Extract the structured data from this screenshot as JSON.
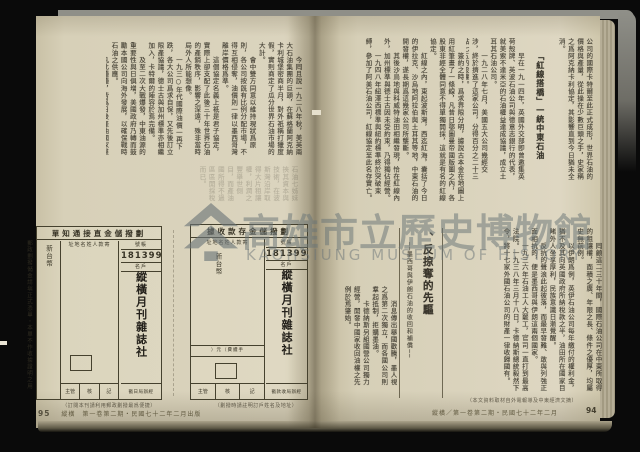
{
  "watermark": {
    "institution": "高雄市立歷史博物館",
    "institution_en": "KAOHSIUNG MUSEUM OF HISTORY"
  },
  "left_page": {
    "page_number": "95",
    "footer": "縱橫　第一卷第二期・民國七十二年二月出版",
    "body_paragraphs": [
      "　　今囘且說一九二八年秋，美英兩大石油集團的巨頭，在蘇格蘭阿克納卡利城堡密商半月，對外祇稱打獵度假，實則商定了瓜分世界石油市場的大計。",
      "　　會中雙方同意以維持現狀爲原則，各公司按旣有比例分配市場，不得互相侵奪，油價則一律以墨西哥灣離岸價格爲準。",
      "　　這個協定名義上祇是君子協定，實際上卻支配了此後三十年世界石油的產銷秩序，影響之深遠，殊非當時局外人所能想像。",
      "　　一九三○年代國際油價一再下跌，各大公司爲求自保，又先後訂立限產協議，德士古與加州標準亦相繼加入，卡特爾的陣容於焉完備。",
      "　　及至二次大戰爆發，中東油源的重要性與日俱增，美國政府乃轉而鼓勵本國公司向海外發展，以確保戰時石油之供應。",
      "　　凡此種種，皆爲日後產油國家羣起抗爭、收回石油主權的遠因。"
    ],
    "ghost_paragraphs": [
      "石油七姊妹挾其資本與技術，在波斯灣沿岸取得大片租讓權，利潤之豐舉世側目，而產油國所得不過區區開採稅而已。"
    ],
    "margin_note": "郵政劃撥儲金請塡正式憑單・本單不作收據證明之用",
    "forms": {
      "notification": {
        "title": "劃撥儲金直接通知單",
        "account_label": "帳號",
        "account_number": "181399",
        "holder_label": "戶名",
        "payee": "縱橫月刊雜誌社",
        "sender_label": "寄款人姓名地址",
        "amount_label": "新台幣",
        "stamp_label": "經辦局日戳",
        "sign_cells": [
          "主管",
          "核",
          "記"
        ],
        "caption": "（訂閱本刊請利用郵政劃撥最爲便捷）"
      },
      "receipt": {
        "title": "劃撥儲金存款收據",
        "account_label": "帳號",
        "account_number": "181399",
        "holder_label": "戶名",
        "payee": "縱橫月刊雜誌社",
        "sender_label": "寄款人姓名地址",
        "amount_label": "新台幣",
        "fee_label": "手續費（元）",
        "stamp_label": "經辦局收款戳",
        "sign_cells": [
          "主管",
          "核",
          "記"
        ],
        "caption": "（劃撥時請註明訂戶姓名及地址）"
      }
    }
  },
  "right_page": {
    "page_number": "94",
    "footer": "縱橫／第一卷第二期・民國七十二年二月",
    "footer_note": "（本文資料取材自外電報導及中東經濟文摘）",
    "section1": {
      "heading": "「紅線搭橋」一統中東石油",
      "intro_paragraphs": [
        "公司的國際卡特爾至此正式成形，世界石油的價格與產量，從此操在少數巨頭之手，史家稱之爲阿克納卡利協定，其影響直到今日猶未全消。"
      ],
      "body_a": [
        "　　早在一九一四年，英國外交部卽曾邀集英荷殼牌、英波石油公司與德意志銀行的代表，就美索不達米亞的石油權益達成協議，成立土耳其石油公司。",
        "　　一九二八年七月，美國五大公司幾經交涉，終於擠進了這家公司，分得百分之二十三點七五的股權。"
      ],
      "body_b": [
        "　　簽約之時，爲求界限分明，據說古本金在地圖上用紅筆畫了一條線，凡昔日鄂圖曼帝國版圖之內，各股東非經全體同意不得單獨開採，這就是有名的紅線協定。",
        "　　紅線之內，東起波斯灣，西迄紅海，囊括了今日的伊拉克、沙烏地阿拉伯與土耳其等地，中東石油的開發權，遂長期爲這幾家公司所壟斷。",
        "　　其後沙烏地與科威特油田相繼發現，恰在紅線內外，加州標準與德士古因未受約束，乃得獨佔經營。",
        "　　一九四八年紐澤西標準與紐約標準終於突破束縛，參加了阿美石油公司，紅線協定至此名存實亡。"
      ]
    },
    "section2": {
      "heading": "、反掠奪的先驅",
      "subtitle": "──墨西哥與伊朗石油的收回和補償──",
      "right_paragraphs": [
        "　　囘顧這二三十年間，國際石油公司在中東所取得的租讓權，面積之廣、年限之長、條件之優厚，均屬史無前例。",
        "　　以伊朗爲例，英伊石油公司每年繳付的權利金，猶不及其向英國政府所納稅款之半，油田所在國家目睹外人坐享厚利，民族意識日漸覺醒。",
        "　　反抗的聲浪此起彼落，而最早發難、敢與列強正面相抗的，便是墨西哥與伊朗這兩個國家。",
        "　　一九三六年石油工人大罷工，官司一直打到最高法院。一九三八年三月十八日，卡德納斯總統毅然下令，將十七家外國石油公司的財產一律收歸國有。"
      ],
      "left_paragraphs": [
        "　　消息傳出舉國歡騰，墨人視之爲第二次獨立，而各國公司則羣起抵制，拒購墨油。",
        "　　卡德納斯另組國營公司獨力經營，開發中國家收回油權之先例於焉肇始。"
      ]
    }
  }
}
